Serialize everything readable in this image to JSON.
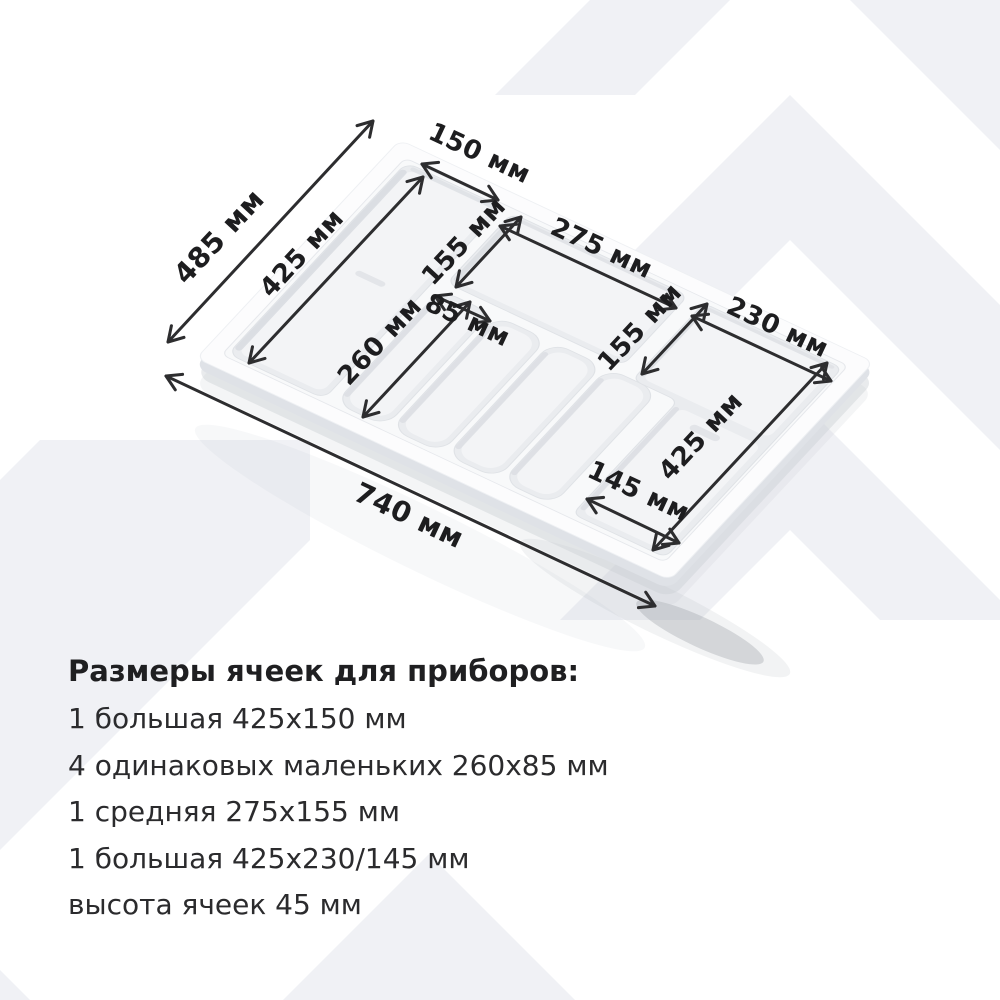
{
  "background": {
    "watermark_color": "#f0f1f5"
  },
  "diagram": {
    "unit": "мм",
    "labels": {
      "d485": "485 мм",
      "d425_left": "425 мм",
      "d150": "150 мм",
      "d155_mid": "155 мм",
      "d275": "275 мм",
      "d85": "85 мм",
      "d260": "260 мм",
      "d155_right": "155 мм",
      "d230": "230 мм",
      "d425_right": "425 мм",
      "d145": "145 мм",
      "d740": "740 мм"
    }
  },
  "specs": {
    "title": "Размеры ячеек для приборов:",
    "items": [
      "1 большая 425х150 мм",
      "4 одинаковых маленьких 260х85 мм",
      "1 средняя 275х155 мм",
      "1 большая 425х230/145 мм",
      "высота ячеек 45 мм"
    ]
  }
}
